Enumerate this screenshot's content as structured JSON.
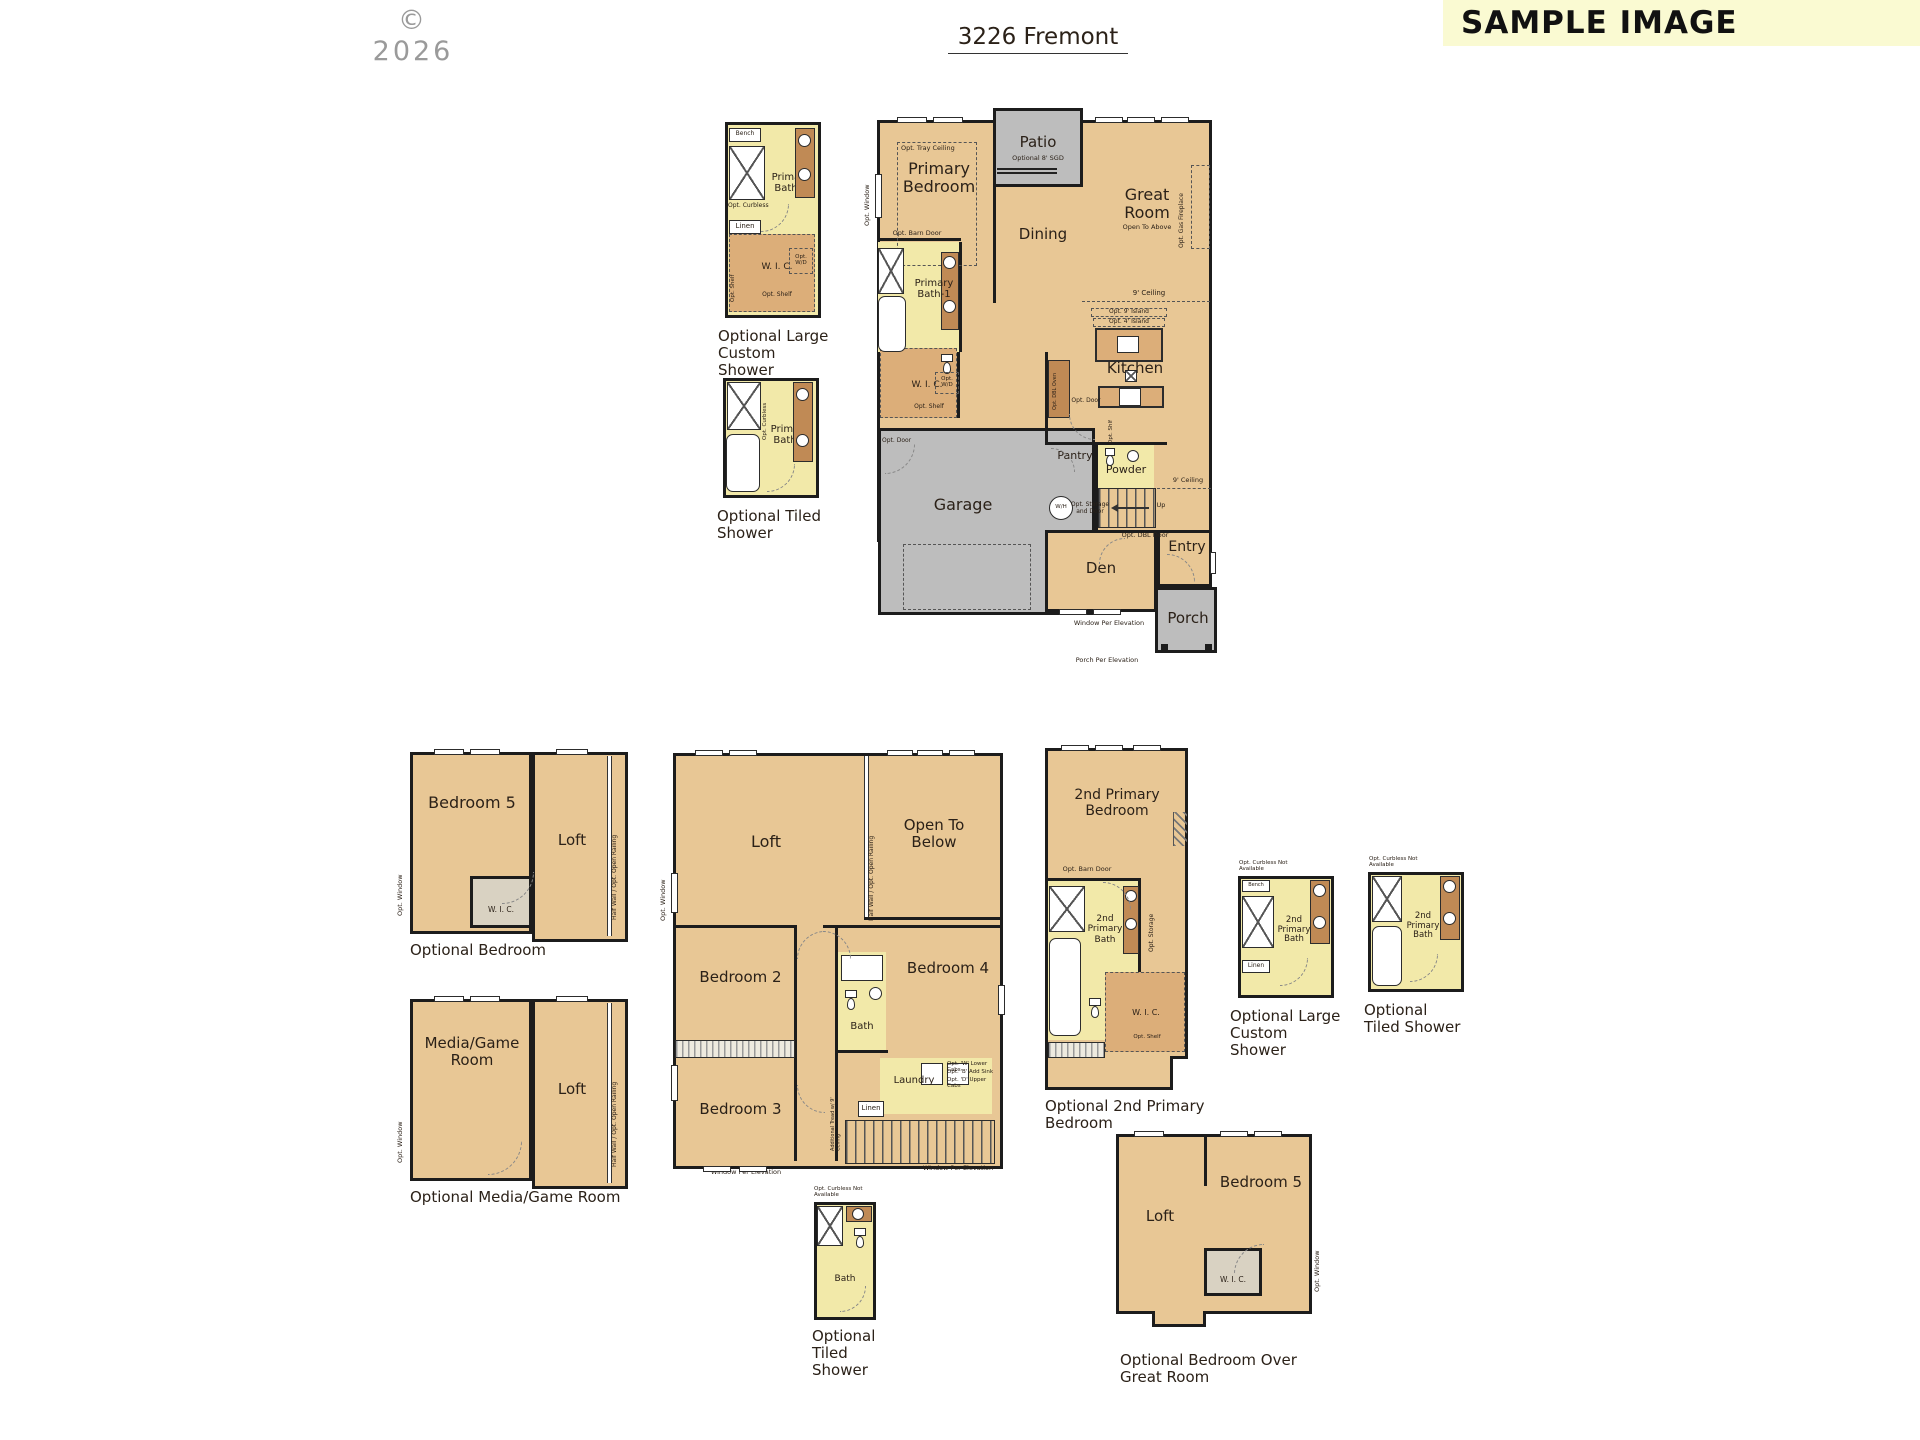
{
  "page": {
    "watermark": "© 2026",
    "title": "3226 Fremont",
    "banner": "SAMPLE IMAGE"
  },
  "colors": {
    "tan": "#e8c795",
    "dark_tan": "#dcae79",
    "bath_yellow": "#f2e9a9",
    "gray": "#bdbdbd",
    "vanity_brown": "#c08a55",
    "wall": "#1c1c1c",
    "banner_bg": "#fafad2",
    "watermark_gray": "#9a9a9a"
  },
  "custom_shower1": {
    "caption": "Optional Large Custom Shower",
    "bench": "Bench",
    "bath": "Primary Bath-1",
    "curbless": "Opt. Curbless",
    "linen": "Linen",
    "wic": "W. I. C.",
    "opt_wd": "Opt. W/D",
    "opt_shelf": "Opt. Shelf",
    "opt_shelf_side": "Opt. Shelf"
  },
  "tiled_shower1": {
    "caption": "Optional Tiled Shower",
    "bath": "Primary Bath-1",
    "curbless": "Opt. Curbless"
  },
  "first_floor": {
    "patio": "Patio",
    "sgd": "Optional 8' SGD",
    "primary_bedroom": "Primary Bedroom",
    "tray_ceiling": "Opt. Tray Ceiling",
    "opt_window": "Opt. Window",
    "barn_door": "Opt. Barn Door",
    "great_room": "Great Room",
    "open_to_above": "Open To Above",
    "gas_fireplace": "Opt. Gas Fireplace",
    "ceiling9_great": "9' Ceiling",
    "ceiling9_stairs": "9' Ceiling",
    "dining": "Dining",
    "primary_bath": "Primary Bath-1",
    "wic": "W. I. C.",
    "opt_wd": "Opt. W/D",
    "opt_shelf": "Opt. Shelf",
    "kitchen": "Kitchen",
    "island9": "Opt. 9' Island",
    "island4": "Opt. 4' Island",
    "dbl_oven": "Opt. DBL Oven",
    "opt_door_kitchen": "Opt. Door",
    "opt_shlf": "Opt. Shlf",
    "pantry": "Pantry",
    "powder": "Powder",
    "storage_door": "Opt. Storage and Door",
    "up": "Up",
    "wh": "W/H",
    "garage": "Garage",
    "opt_door_garage": "Opt. Door",
    "den": "Den",
    "dbl_door": "Opt. DBL Door",
    "entry": "Entry",
    "porch": "Porch",
    "window_per_elev": "Window Per Elevation",
    "porch_per_elev": "Porch Per Elevation"
  },
  "opt_bedroom": {
    "caption": "Optional Bedroom",
    "bedroom5": "Bedroom 5",
    "loft": "Loft",
    "wic": "W. I. C.",
    "opt_window": "Opt. Window",
    "half_wall": "Half Wall / Opt. Open Railing"
  },
  "opt_media": {
    "caption": "Optional Media/Game Room",
    "media": "Media/Game Room",
    "loft": "Loft",
    "opt_window": "Opt. Window",
    "half_wall": "Half Wall / Opt. Open Railing"
  },
  "second_floor": {
    "loft": "Loft",
    "open_to_below": "Open To Below",
    "half_wall": "Half Wall / Opt. Open Railing",
    "opt_window": "Opt. Window",
    "bedroom2": "Bedroom 2",
    "bedroom3": "Bedroom 3",
    "bedroom4": "Bedroom 4",
    "bath": "Bath",
    "laundry": "Laundry",
    "linen": "Linen",
    "opt_w": "Opt. 'W' Lower Cabs",
    "opt_b": "Opt. 'B' Add Sink",
    "opt_d": "Opt. 'D' Upper Cabs",
    "tread": "Additional Tread w/ 9' Ceiling",
    "window_per_elev_l": "Window Per Elevation",
    "window_per_elev_r": "Window Per Elevation"
  },
  "opt_2nd_primary": {
    "caption": "Optional 2nd Primary Bedroom",
    "bedroom": "2nd Primary Bedroom",
    "barn_door": "Opt. Barn Door",
    "bath": "2nd Primary Bath",
    "wic": "W. I. C.",
    "opt_shelf": "Opt. Shelf",
    "storage": "Opt. Storage"
  },
  "custom_shower2": {
    "caption": "Optional Large Custom Shower",
    "curbless_na": "Opt. Curbless Not Available",
    "bench": "Bench",
    "bath": "2nd Primary Bath",
    "linen": "Linen"
  },
  "tiled_shower2": {
    "caption": "Optional Tiled Shower",
    "curbless_na": "Opt. Curbless Not Available",
    "bath": "2nd Primary Bath"
  },
  "tiled_shower3": {
    "caption": "Optional Tiled Shower",
    "curbless_na": "Opt. Curbless Not Available",
    "bath": "Bath"
  },
  "opt_bedroom_over": {
    "caption": "Optional Bedroom Over Great Room",
    "loft": "Loft",
    "bedroom5": "Bedroom 5",
    "wic": "W. I. C.",
    "opt_window": "Opt. Window"
  }
}
